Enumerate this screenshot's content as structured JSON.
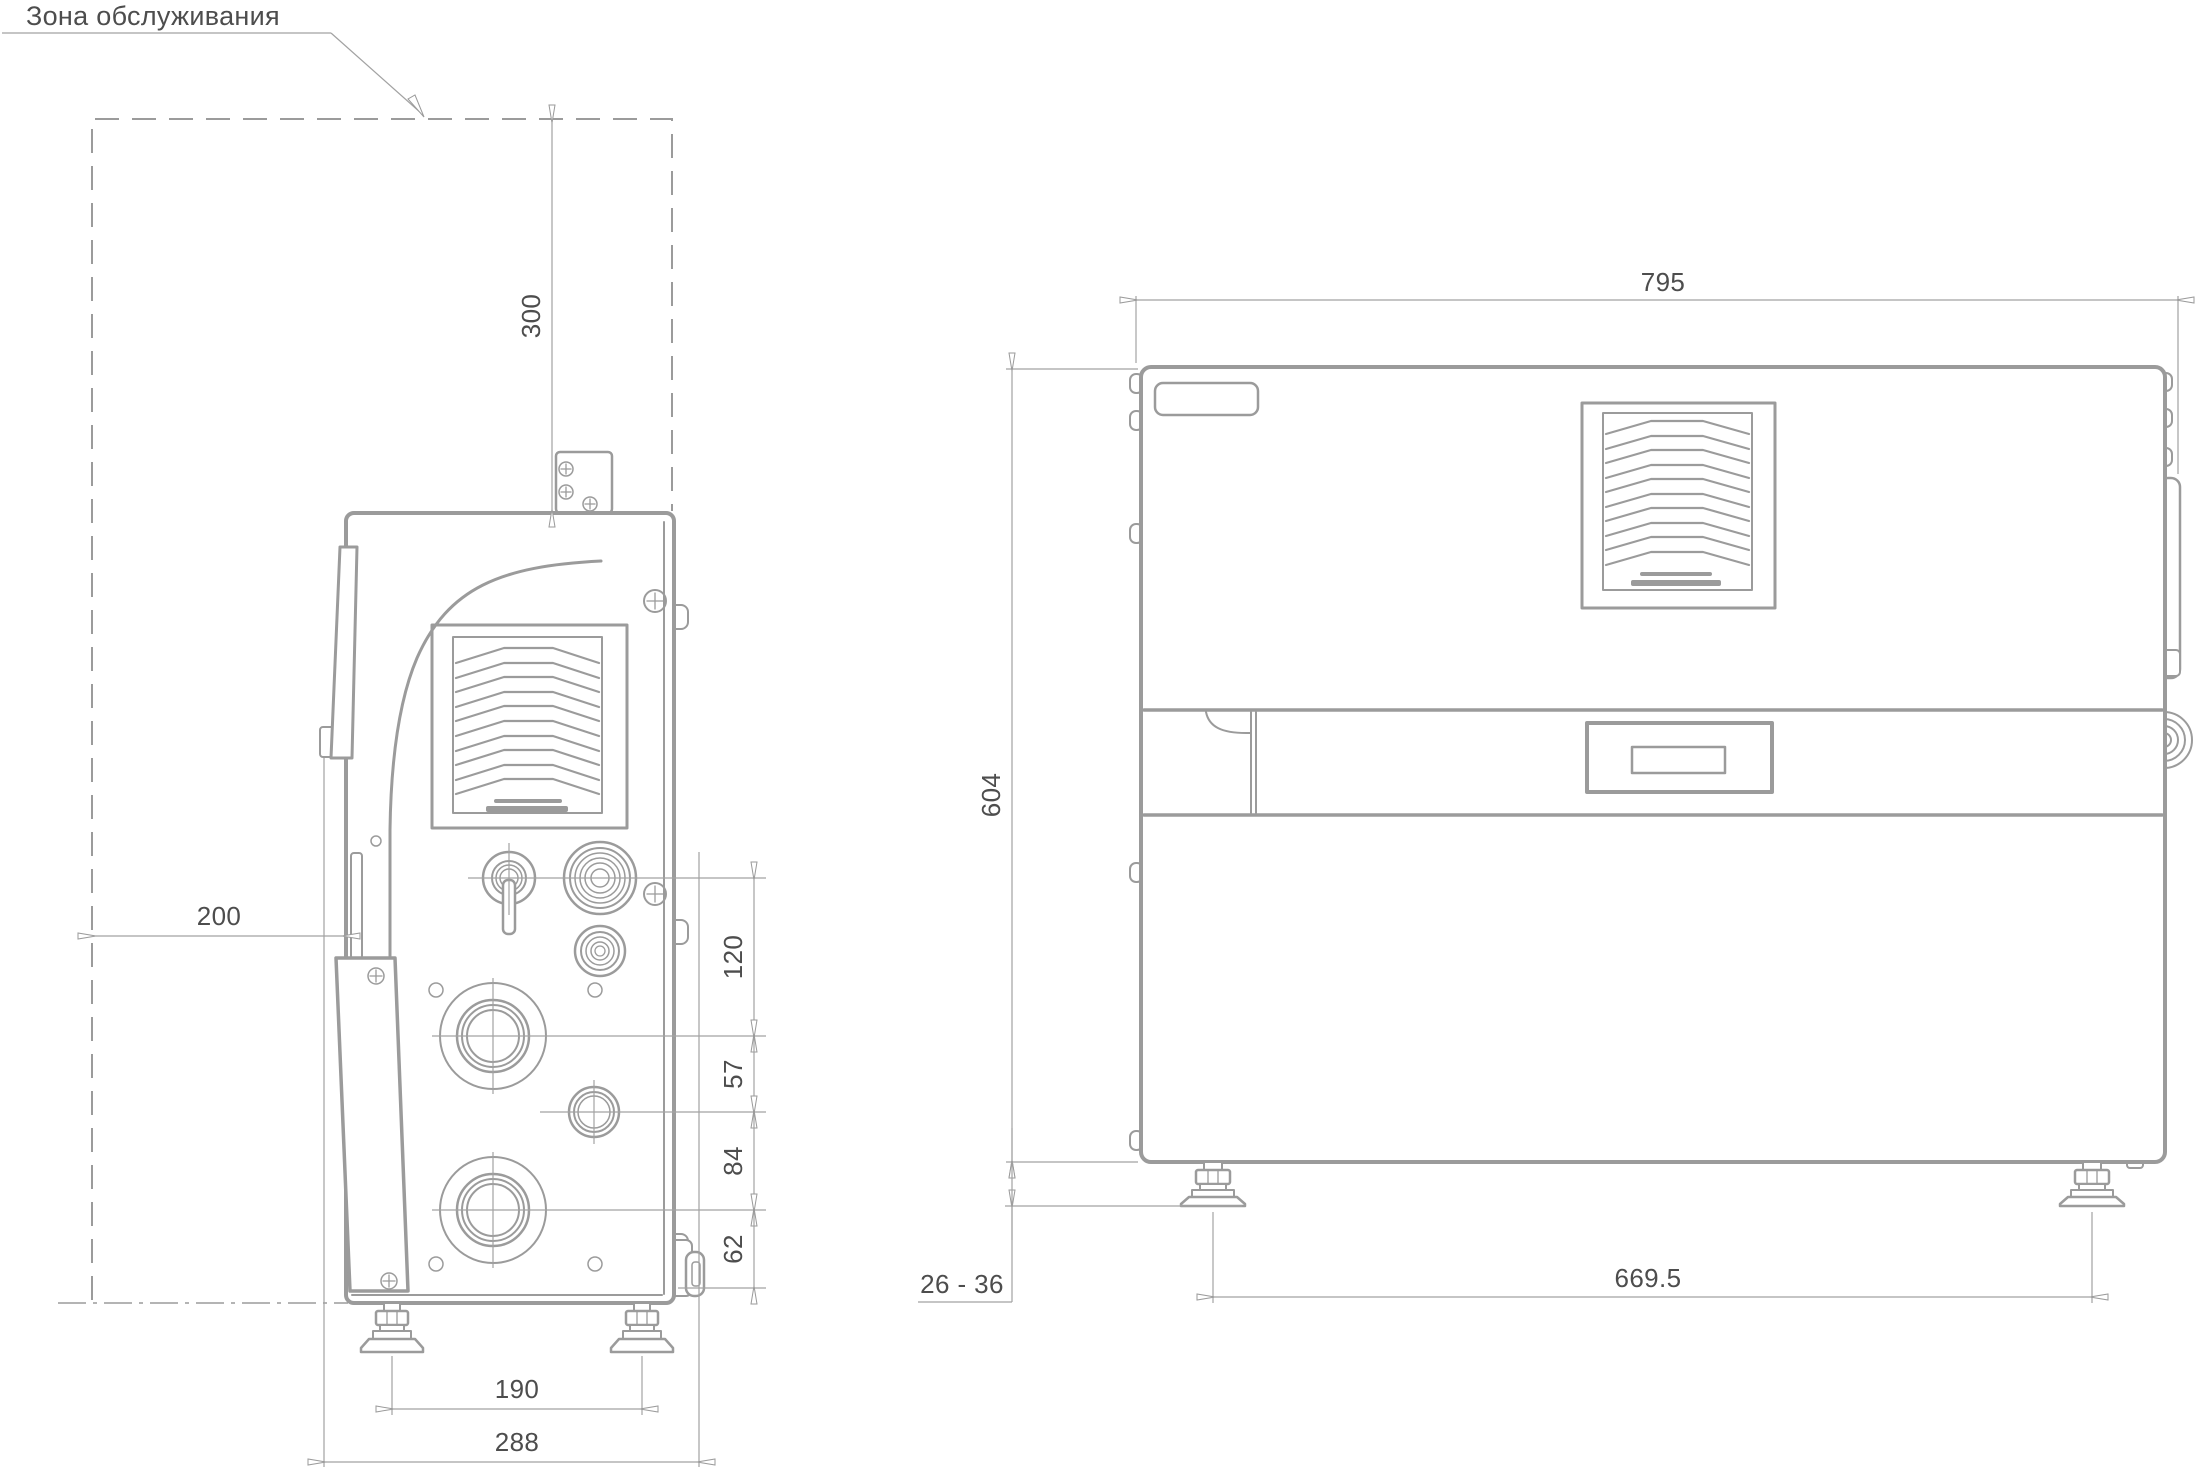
{
  "colors": {
    "outline": "#9b9b9b",
    "dim_line": "#a2a2a2",
    "text": "#4d4d4d"
  },
  "service_zone": {
    "label": "Зона обслуживания"
  },
  "side_view": {
    "dims": {
      "top_clearance": "300",
      "left_clearance": "200",
      "port_spacing_1": "120",
      "port_spacing_2": "57",
      "port_spacing_3": "84",
      "port_spacing_4": "62",
      "feet_spacing": "190",
      "overall_depth": "288"
    }
  },
  "front_view": {
    "dims": {
      "overall_width": "795",
      "overall_height": "604",
      "feet_height_range": "26 - 36",
      "feet_spacing": "669.5"
    }
  }
}
